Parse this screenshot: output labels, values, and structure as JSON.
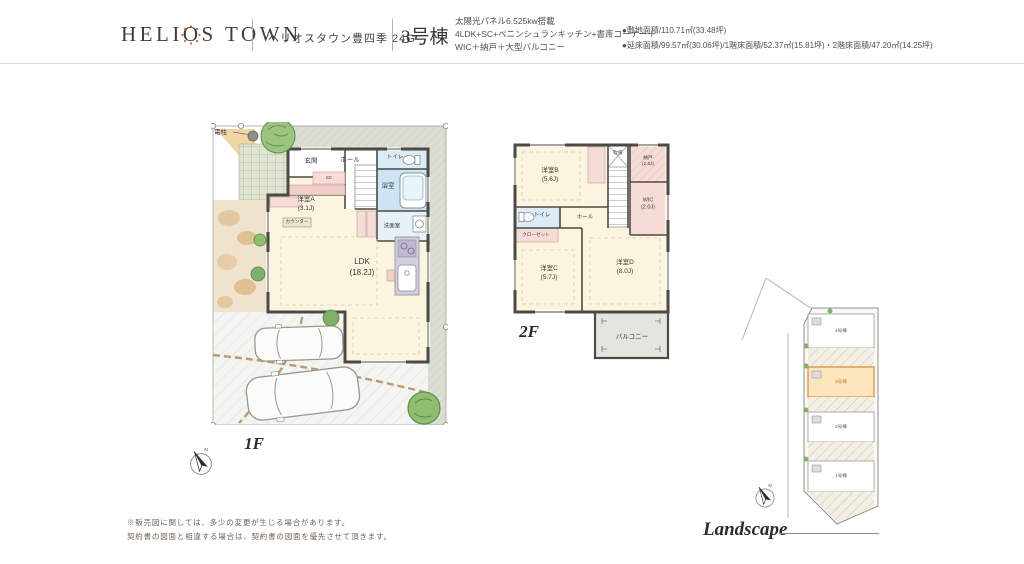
{
  "header": {
    "logo_part1": "HELI",
    "logo_part2": "O",
    "logo_part3": "S TOWN",
    "project_name": "ヘリオスタウン豊四季 24G",
    "building_no": "3号棟",
    "spec_line1": "太陽光パネル6.525kw搭載",
    "spec_line2": "4LDK+SC+ペニンシュランキッチン+書斎コーナー＋",
    "spec_line3": "WIC＋納戸＋大型バルコニー",
    "site_area": "●敷地面積/110.71㎡(33.48坪)",
    "floor_area": "●延床面積/99.57㎡(30.06坪)/1階床面積/52.37㎡(15.81坪)・2階床面積/47.20㎡(14.25坪)"
  },
  "floor1": {
    "label": "1F",
    "pole_label": "電柱",
    "rooms": {
      "genkan": {
        "name": "玄関"
      },
      "hall": {
        "name": "ホール"
      },
      "toilet": {
        "name": "トイレ"
      },
      "bath": {
        "name": "浴室"
      },
      "washroom": {
        "name": "洗面室"
      },
      "roomA": {
        "name": "洋室A",
        "size": "(3.1J)"
      },
      "ldk": {
        "name": "LDK",
        "size": "(18.2J)"
      },
      "sc": {
        "name": "SC"
      },
      "counter": {
        "name": "カウンター"
      }
    }
  },
  "floor2": {
    "label": "2F",
    "rooms": {
      "roomB": {
        "name": "洋室B",
        "size": "(5.6J)"
      },
      "nando": {
        "name": "納戸",
        "size": "(2.6J)"
      },
      "wic": {
        "name": "WIC",
        "size": "(2.0J)"
      },
      "toilet": {
        "name": "トイレ"
      },
      "hall": {
        "name": "ホール"
      },
      "closet": {
        "name": "クローゼット"
      },
      "void": {
        "name": "吹抜"
      },
      "roomC": {
        "name": "洋室C",
        "size": "(5.7J)"
      },
      "roomD": {
        "name": "洋室D",
        "size": "(8.0J)"
      },
      "balcony": {
        "name": "バルコニー"
      }
    }
  },
  "landscape": {
    "label": "Landscape",
    "compass_n": "N",
    "lots": {
      "lot4": "4号棟",
      "lot3": "3号棟",
      "lot2": "2号棟",
      "lot1": "1号棟"
    }
  },
  "footer": {
    "line1": "※販売図に関しては、多少の変更が生じる場合があります。",
    "line2": "契約書の図面と相違する場合は、契約書の図面を優先させて頂きます。"
  }
}
